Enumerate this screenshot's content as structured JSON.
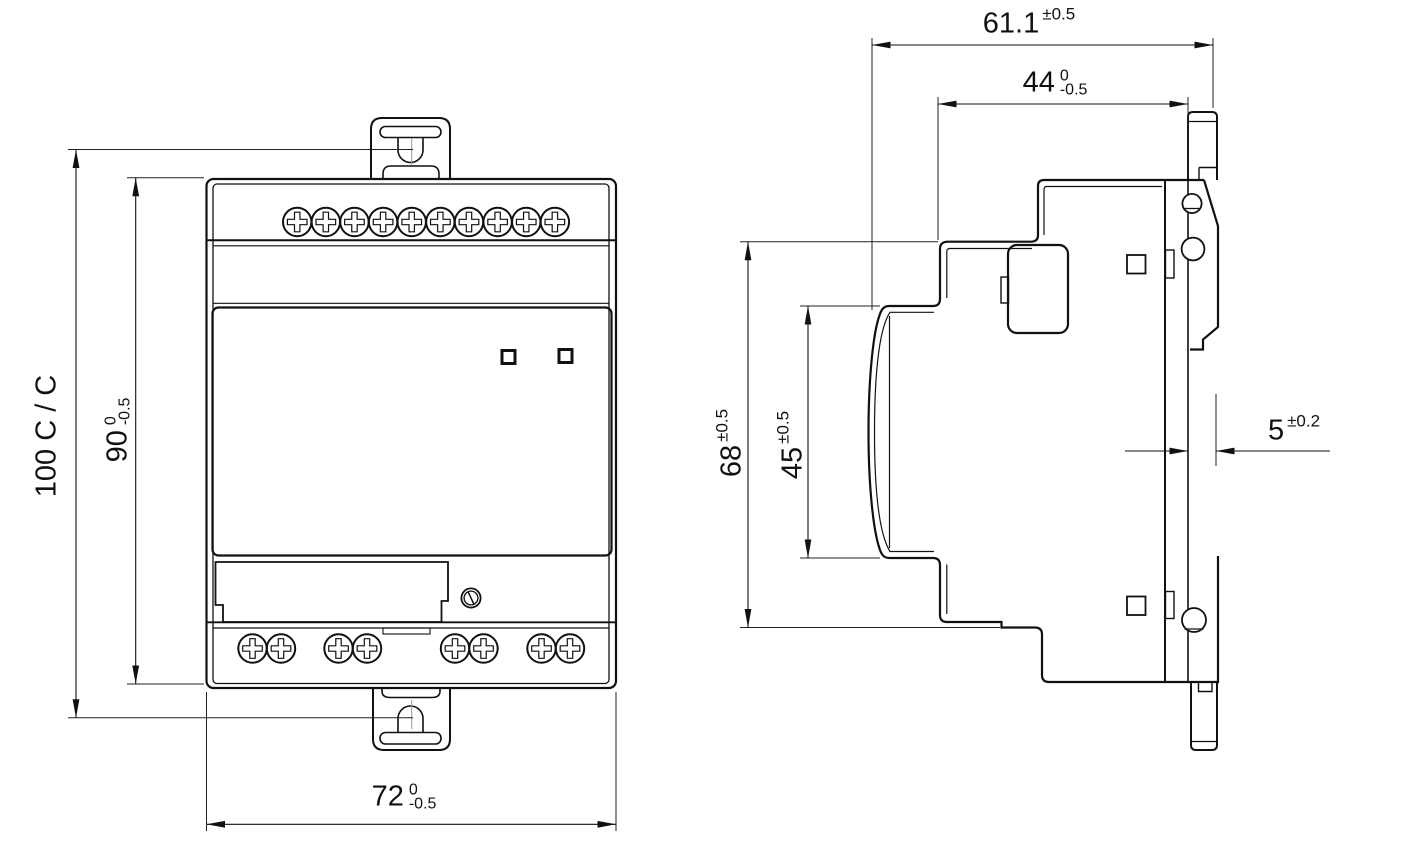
{
  "drawing": {
    "front_view": {
      "dim_mounting_centers": {
        "value": "100 C / C"
      },
      "dim_height": {
        "value": "90",
        "tol_upper": "0",
        "tol_lower": "-0.5"
      },
      "dim_width": {
        "value": "72",
        "tol_upper": "0",
        "tol_lower": "-0.5"
      }
    },
    "side_view": {
      "dim_overall_depth": {
        "value": "61.1",
        "tol": "±0.5"
      },
      "dim_upper_depth": {
        "value": "44",
        "tol_upper": "0",
        "tol_lower": "-0.5"
      },
      "dim_body_height": {
        "value": "68",
        "tol": "±0.5"
      },
      "dim_front_height": {
        "value": "45",
        "tol": "±0.5"
      },
      "dim_rail_depth": {
        "value": "5",
        "tol": "±0.2"
      }
    },
    "device": {
      "top_terminal_screws": 10,
      "bottom_terminal_screws": 8,
      "status_leds": 2
    },
    "colors": {
      "line": "#111111",
      "background": "#ffffff"
    }
  }
}
